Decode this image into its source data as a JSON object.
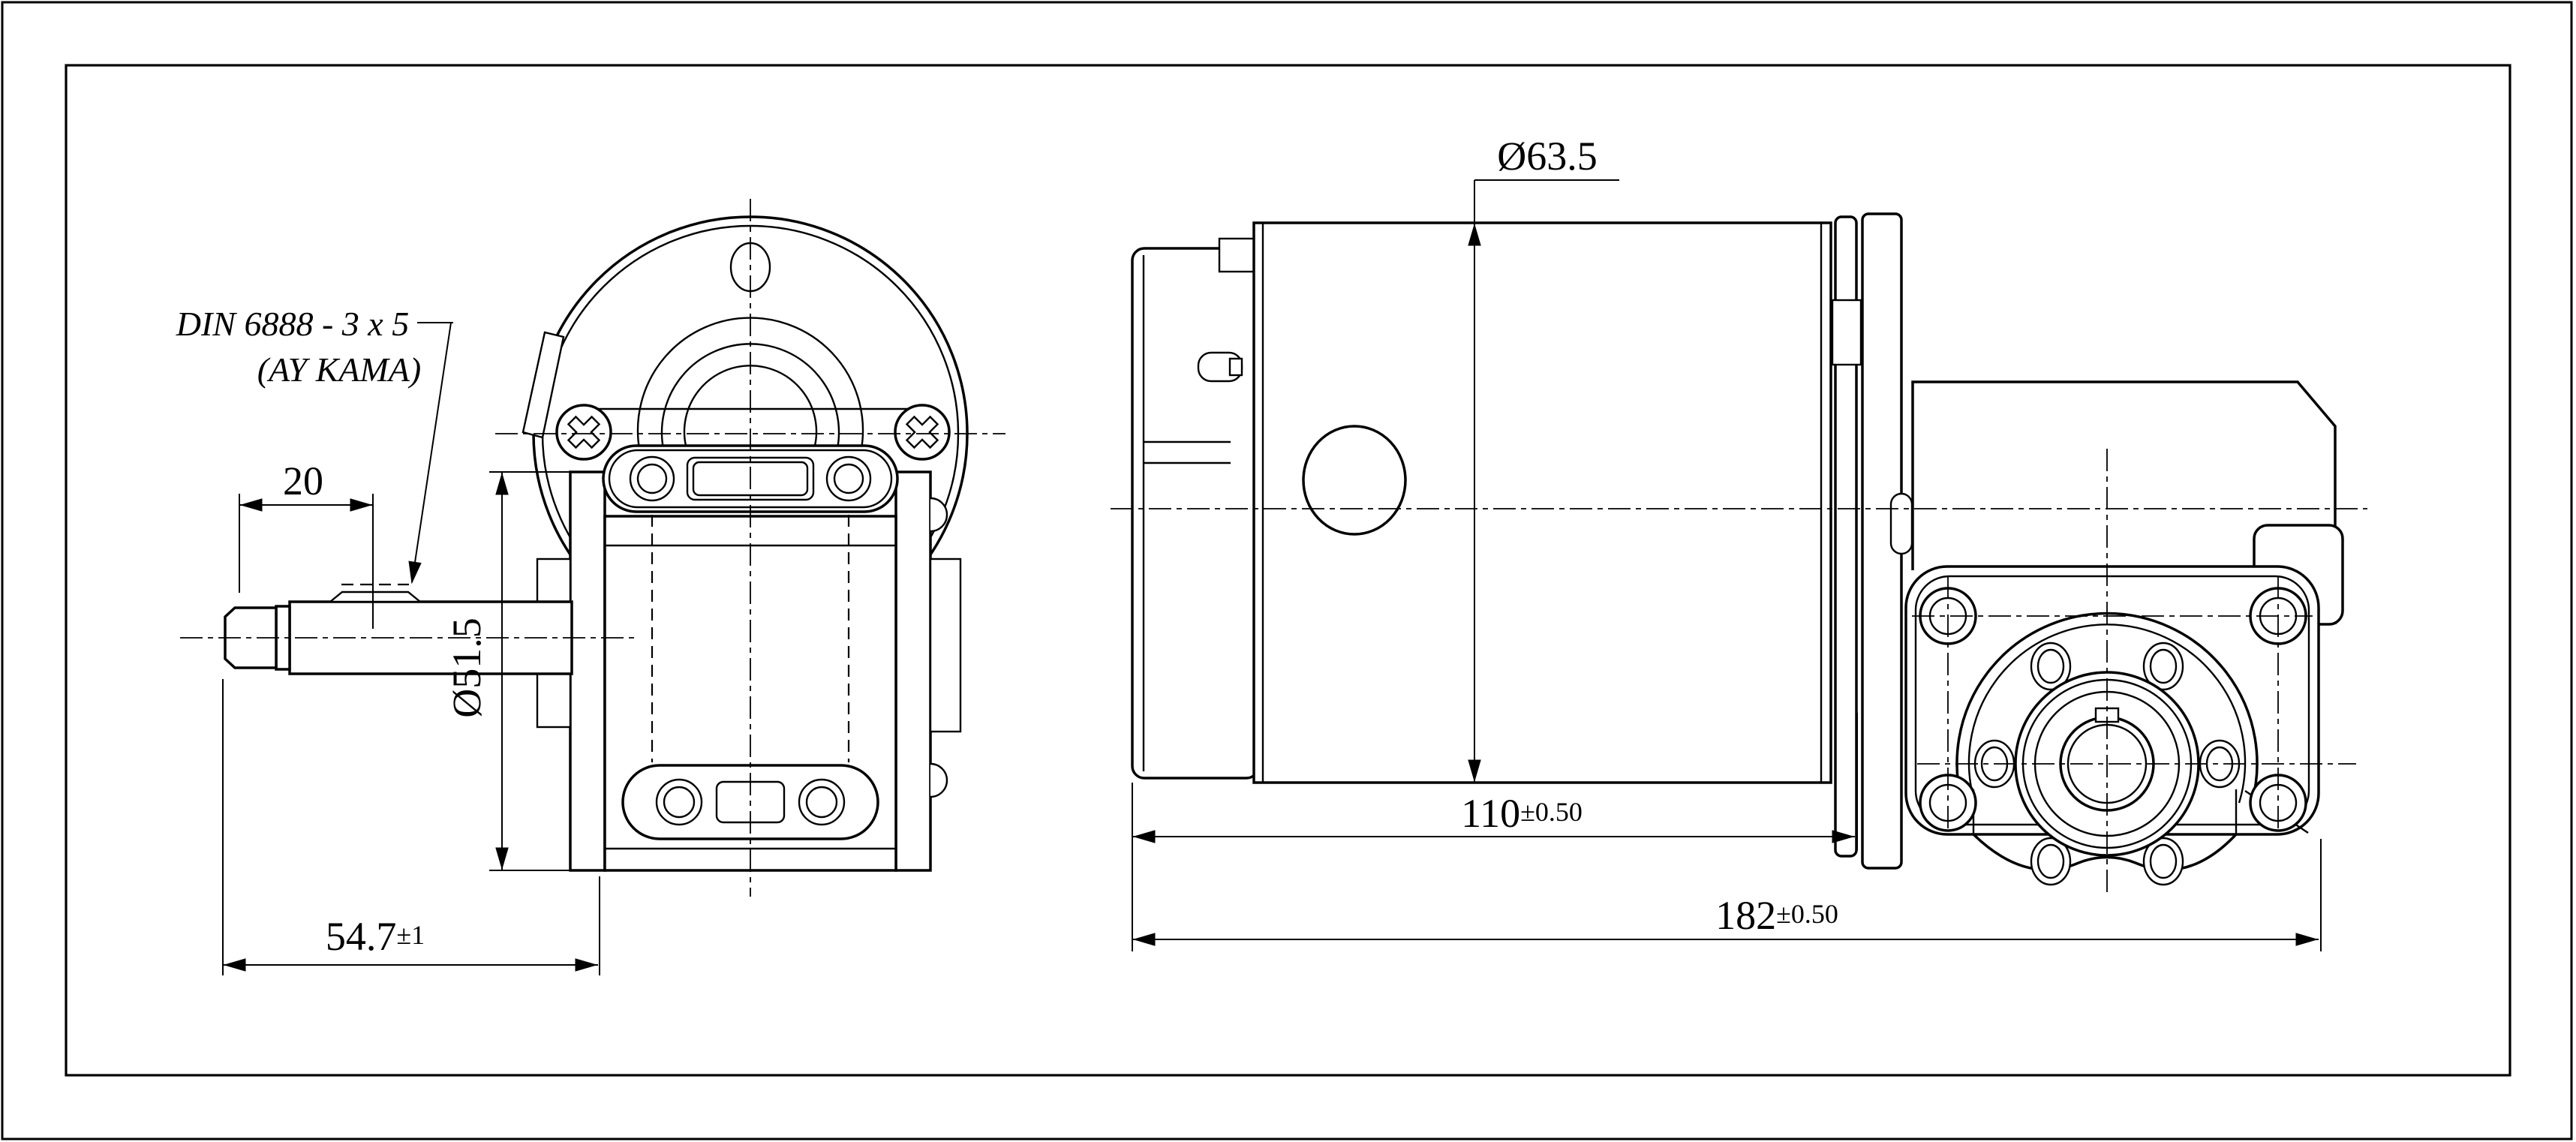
{
  "drawing": {
    "type": "worm-gear-motor-2-view-technical-drawing",
    "background": "#ffffff",
    "line_color": "#000000",
    "annotations": {
      "key_standard": "DIN 6888 - 3 x 5",
      "key_standard_note": "(AY KAMA)"
    },
    "dimensions": {
      "key_position": {
        "value": "20",
        "tolerance": ""
      },
      "boss_diameter": {
        "value": "Ø51.5",
        "tolerance": ""
      },
      "shaft_length": {
        "value": "54.7",
        "tolerance": "±1"
      },
      "motor_diameter": {
        "value": "Ø63.5",
        "tolerance": ""
      },
      "motor_length": {
        "value": "110",
        "tolerance": "±0.50"
      },
      "overall_length": {
        "value": "182",
        "tolerance": "±0.50"
      }
    }
  }
}
